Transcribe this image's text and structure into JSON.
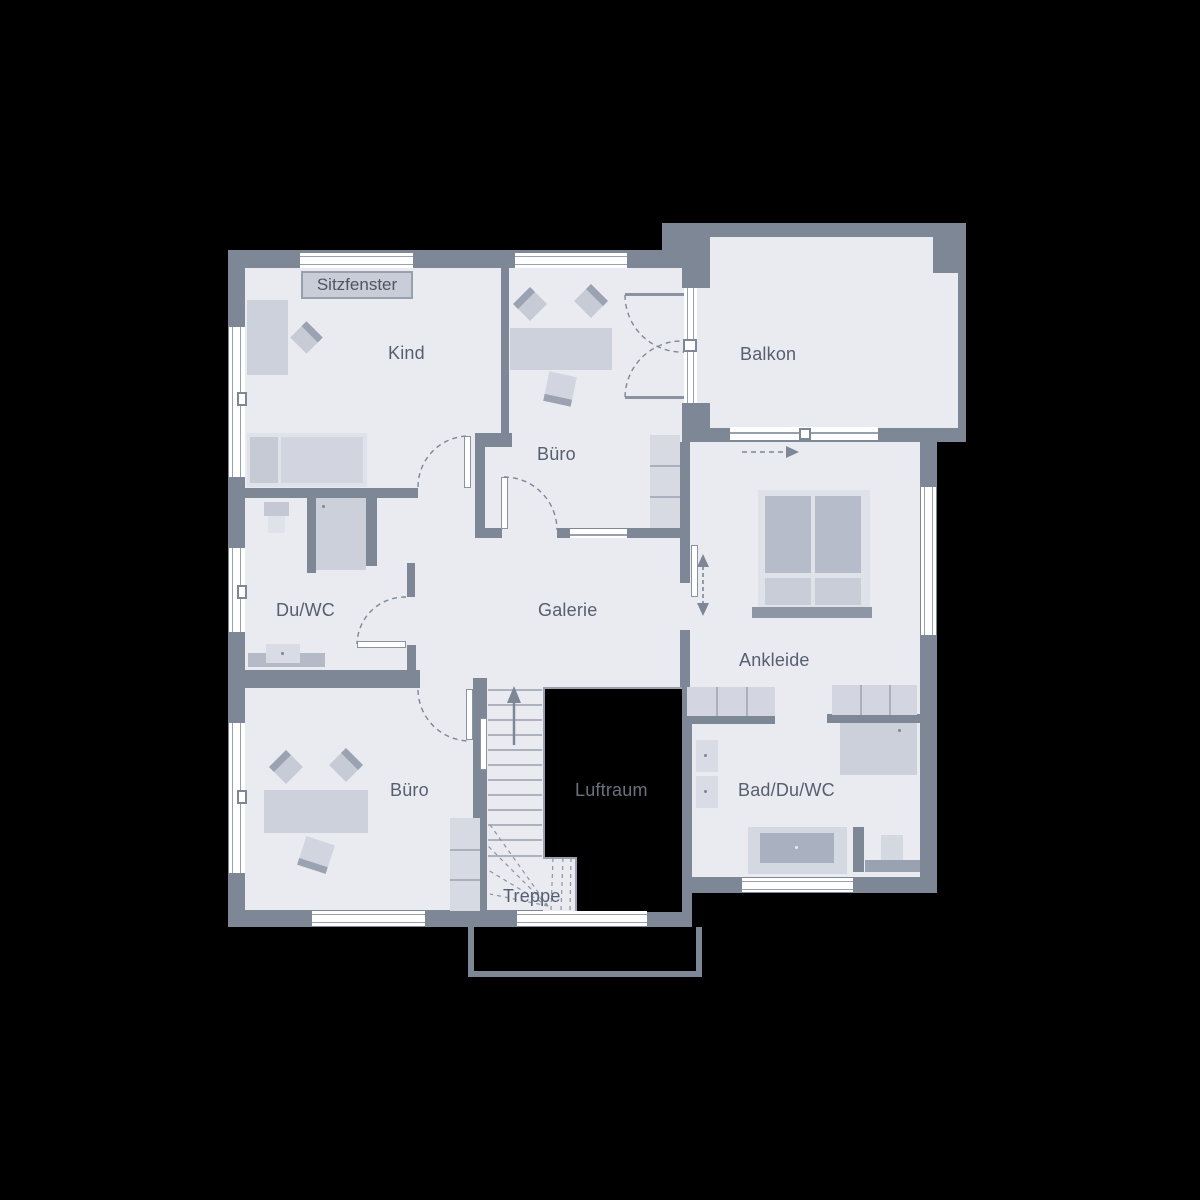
{
  "plan": {
    "labels": {
      "sitzfenster": "Sitzfenster",
      "kind": "Kind",
      "buero_top": "Büro",
      "balkon": "Balkon",
      "du_wc": "Du/WC",
      "galerie": "Galerie",
      "ankleide": "Ankleide",
      "buero_bottom": "Büro",
      "luftraum": "Luftraum",
      "bad_du_wc": "Bad/Du/WC",
      "treppe": "Treppe"
    },
    "colors": {
      "background": "#000000",
      "wall": "#7e8796",
      "floor": "#e9ebf1",
      "furniture_light": "#d7dae2",
      "furniture_mid": "#cdd1dc",
      "furniture_dark": "#9ba3b2",
      "accent_dark": "#8e96a6",
      "line": "#98a0ae",
      "window": "#ffffff",
      "text": "#565e6f",
      "void_text": "#6a7180"
    }
  }
}
